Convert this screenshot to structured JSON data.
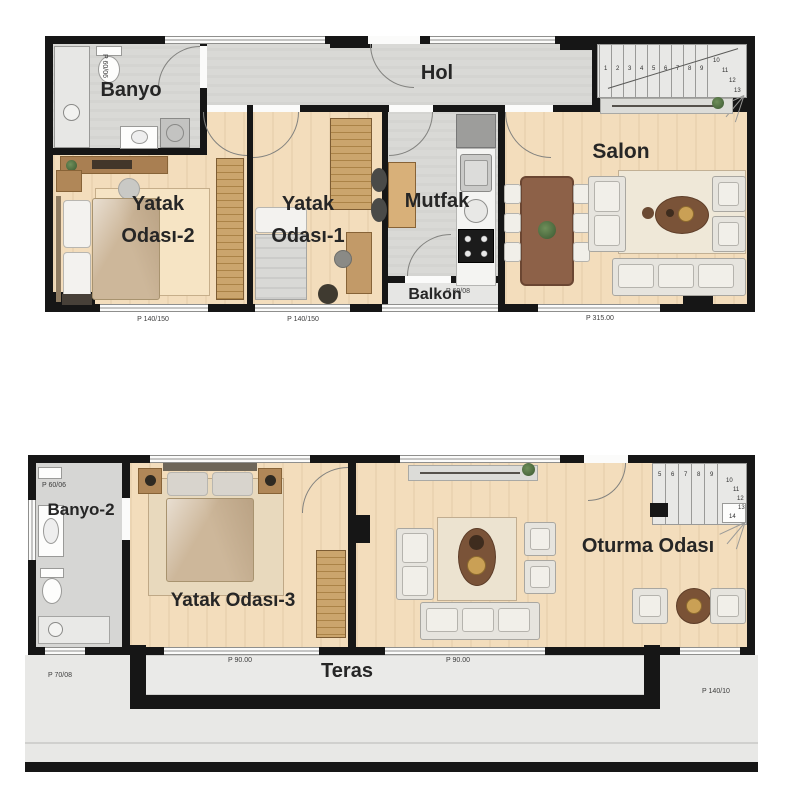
{
  "upper_floor": {
    "hol": "Hol",
    "banyo": "Banyo",
    "yatak2_l1": "Yatak",
    "yatak2_l2": "Odası-2",
    "yatak1_l1": "Yatak",
    "yatak1_l2": "Odası-1",
    "mutfak": "Mutfak",
    "balkon": "Balkon",
    "salon": "Salon",
    "stair_steps": [
      "1",
      "2",
      "3",
      "4",
      "5",
      "6",
      "7",
      "8",
      "9",
      "10",
      "11",
      "12",
      "13"
    ],
    "dims": {
      "banyo_side": "P 60/06",
      "yatak2_window": "P 140/150",
      "yatak1_window": "P 140/150",
      "balkon_sill": "P 60/08",
      "salon_window": "P 315.00"
    }
  },
  "lower_floor": {
    "banyo2": "Banyo-2",
    "yatak3": "Yatak Odası-3",
    "oturma": "Oturma Odası",
    "teras": "Teras",
    "stair_steps": [
      "5",
      "6",
      "7",
      "8",
      "9",
      "10",
      "11",
      "12",
      "13",
      "14"
    ],
    "dims": {
      "banyo2_side": "P 60/06",
      "banyo2_window": "P 70/08",
      "teras_window_1": "P 90.00",
      "teras_window_2": "P 90.00",
      "oturma_window": "P 140/10"
    }
  },
  "colors": {
    "wall": "#161616",
    "wood_floor": "#f3ddbc",
    "tile_floor": "#d9d9d6",
    "terrace_floor": "#eaeae8"
  }
}
